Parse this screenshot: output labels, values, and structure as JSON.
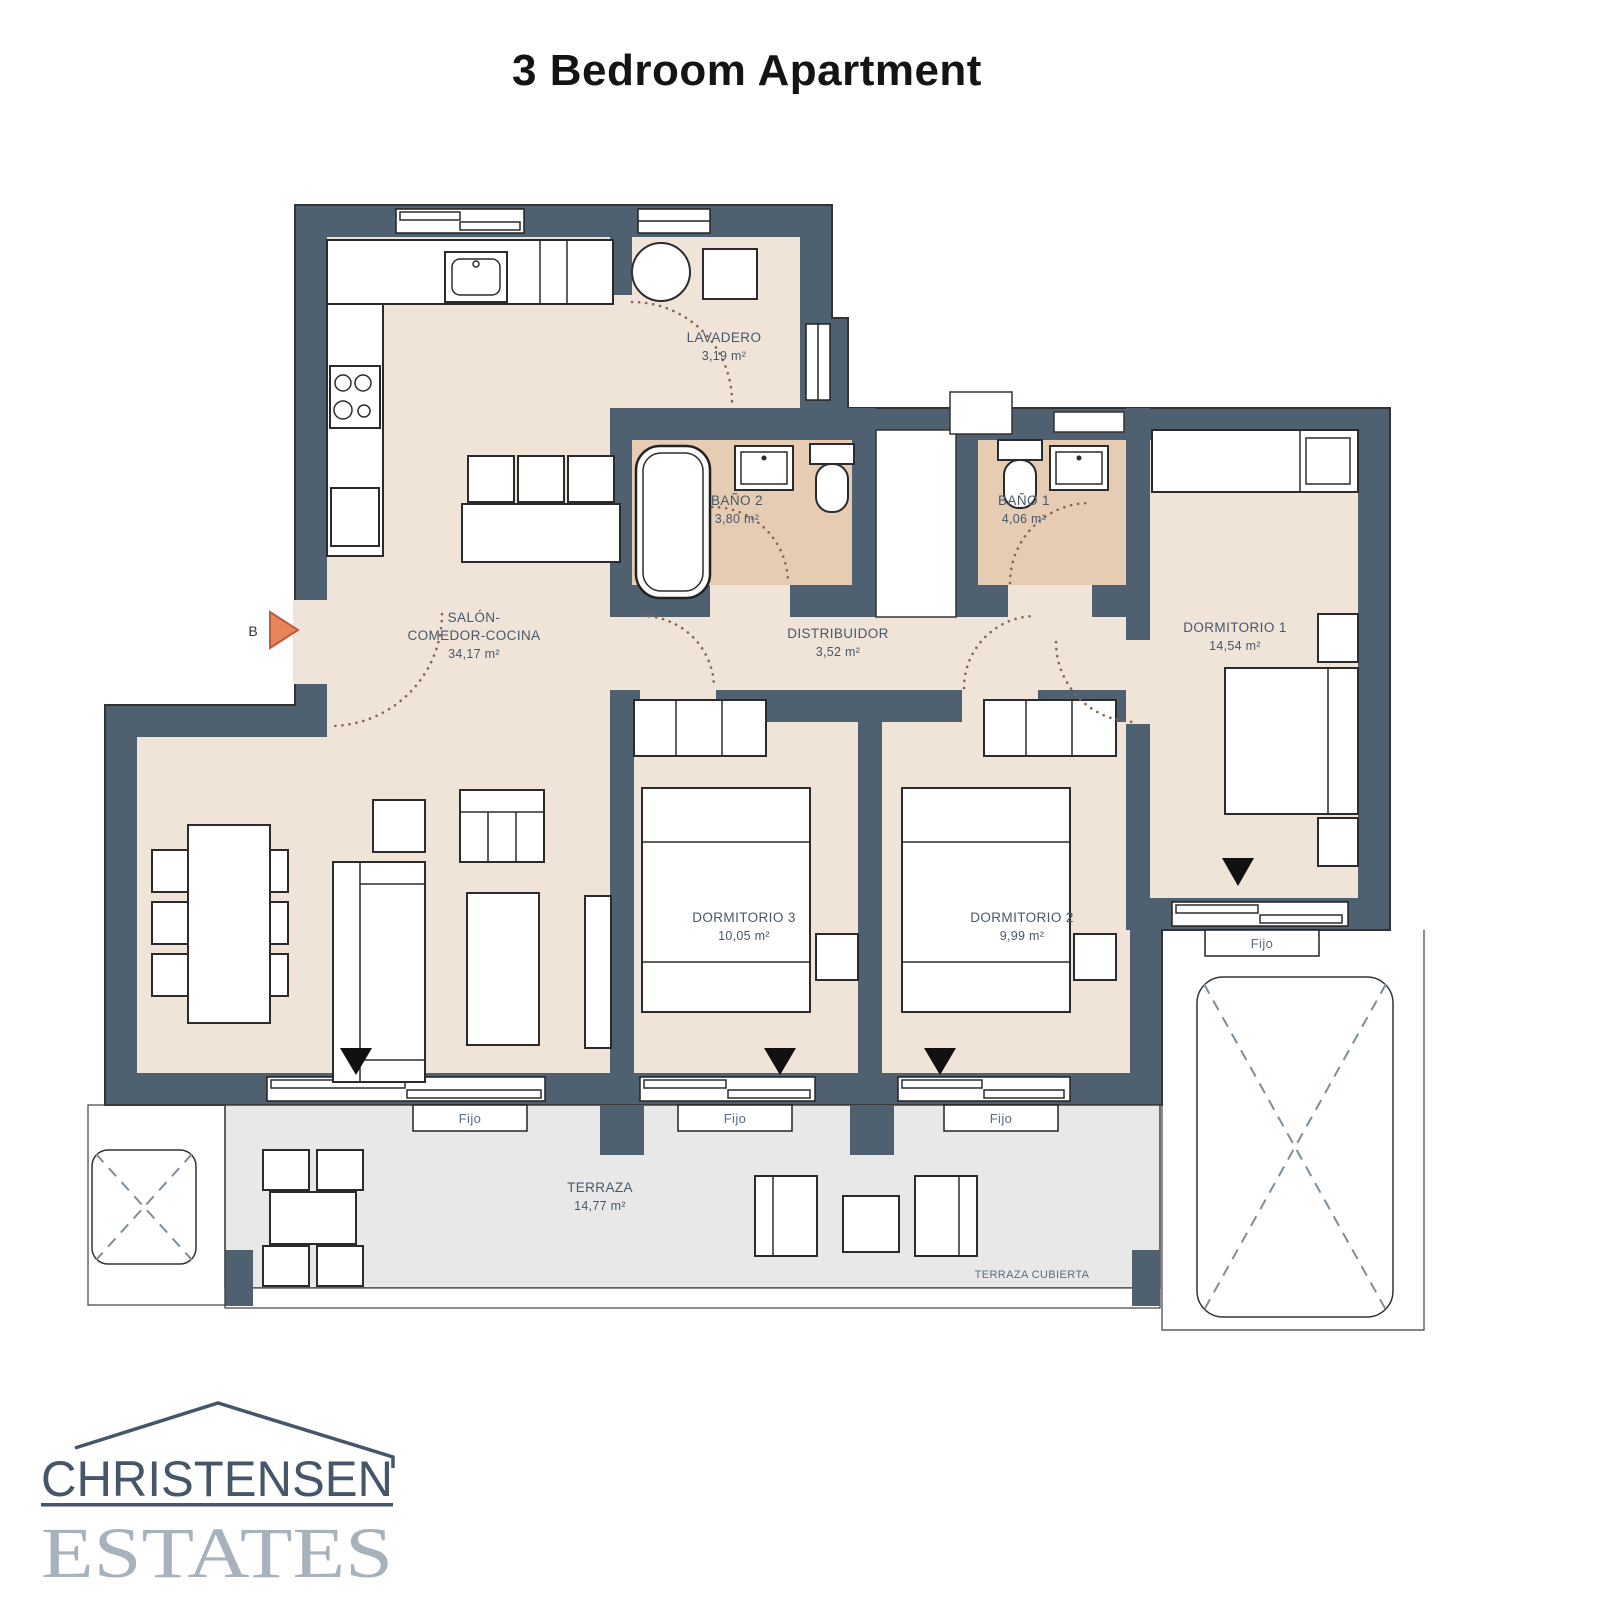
{
  "title": "3 Bedroom Apartment",
  "entrance": {
    "label": "B"
  },
  "rooms": {
    "lavadero": {
      "name": "LAVADERO",
      "area": "3,19 m²"
    },
    "bano2": {
      "name": "BAÑO 2",
      "area": "3,80 m²"
    },
    "bano1": {
      "name": "BAÑO 1",
      "area": "4,06 m²"
    },
    "salon": {
      "name_line1": "SALÓN-",
      "name_line2": "COMEDOR-COCINA",
      "area": "34,17 m²"
    },
    "distribuidor": {
      "name": "DISTRIBUIDOR",
      "area": "3,52 m²"
    },
    "dormitorio1": {
      "name": "DORMITORIO 1",
      "area": "14,54 m²"
    },
    "dormitorio2": {
      "name": "DORMITORIO 2",
      "area": "9,99 m²"
    },
    "dormitorio3": {
      "name": "DORMITORIO 3",
      "area": "10,05 m²"
    },
    "terraza": {
      "name": "TERRAZA",
      "area": "14,77 m²"
    },
    "terraza_cubierta": {
      "name": "TERRAZA CUBIERTA"
    }
  },
  "windows": {
    "fixed_label": "Fijo"
  },
  "logo": {
    "line1": "CHRISTENSEN",
    "line2": "ESTATES"
  },
  "colors": {
    "wall": "#4f6070",
    "floor": "#f0e3d8",
    "bathroom_floor": "#e5ccb3",
    "terrace": "#e8e8e8",
    "entrance_arrow": "#e8845c",
    "label_text": "#47586a",
    "logo_dark": "#45566a",
    "logo_light": "#a7b2bd"
  }
}
